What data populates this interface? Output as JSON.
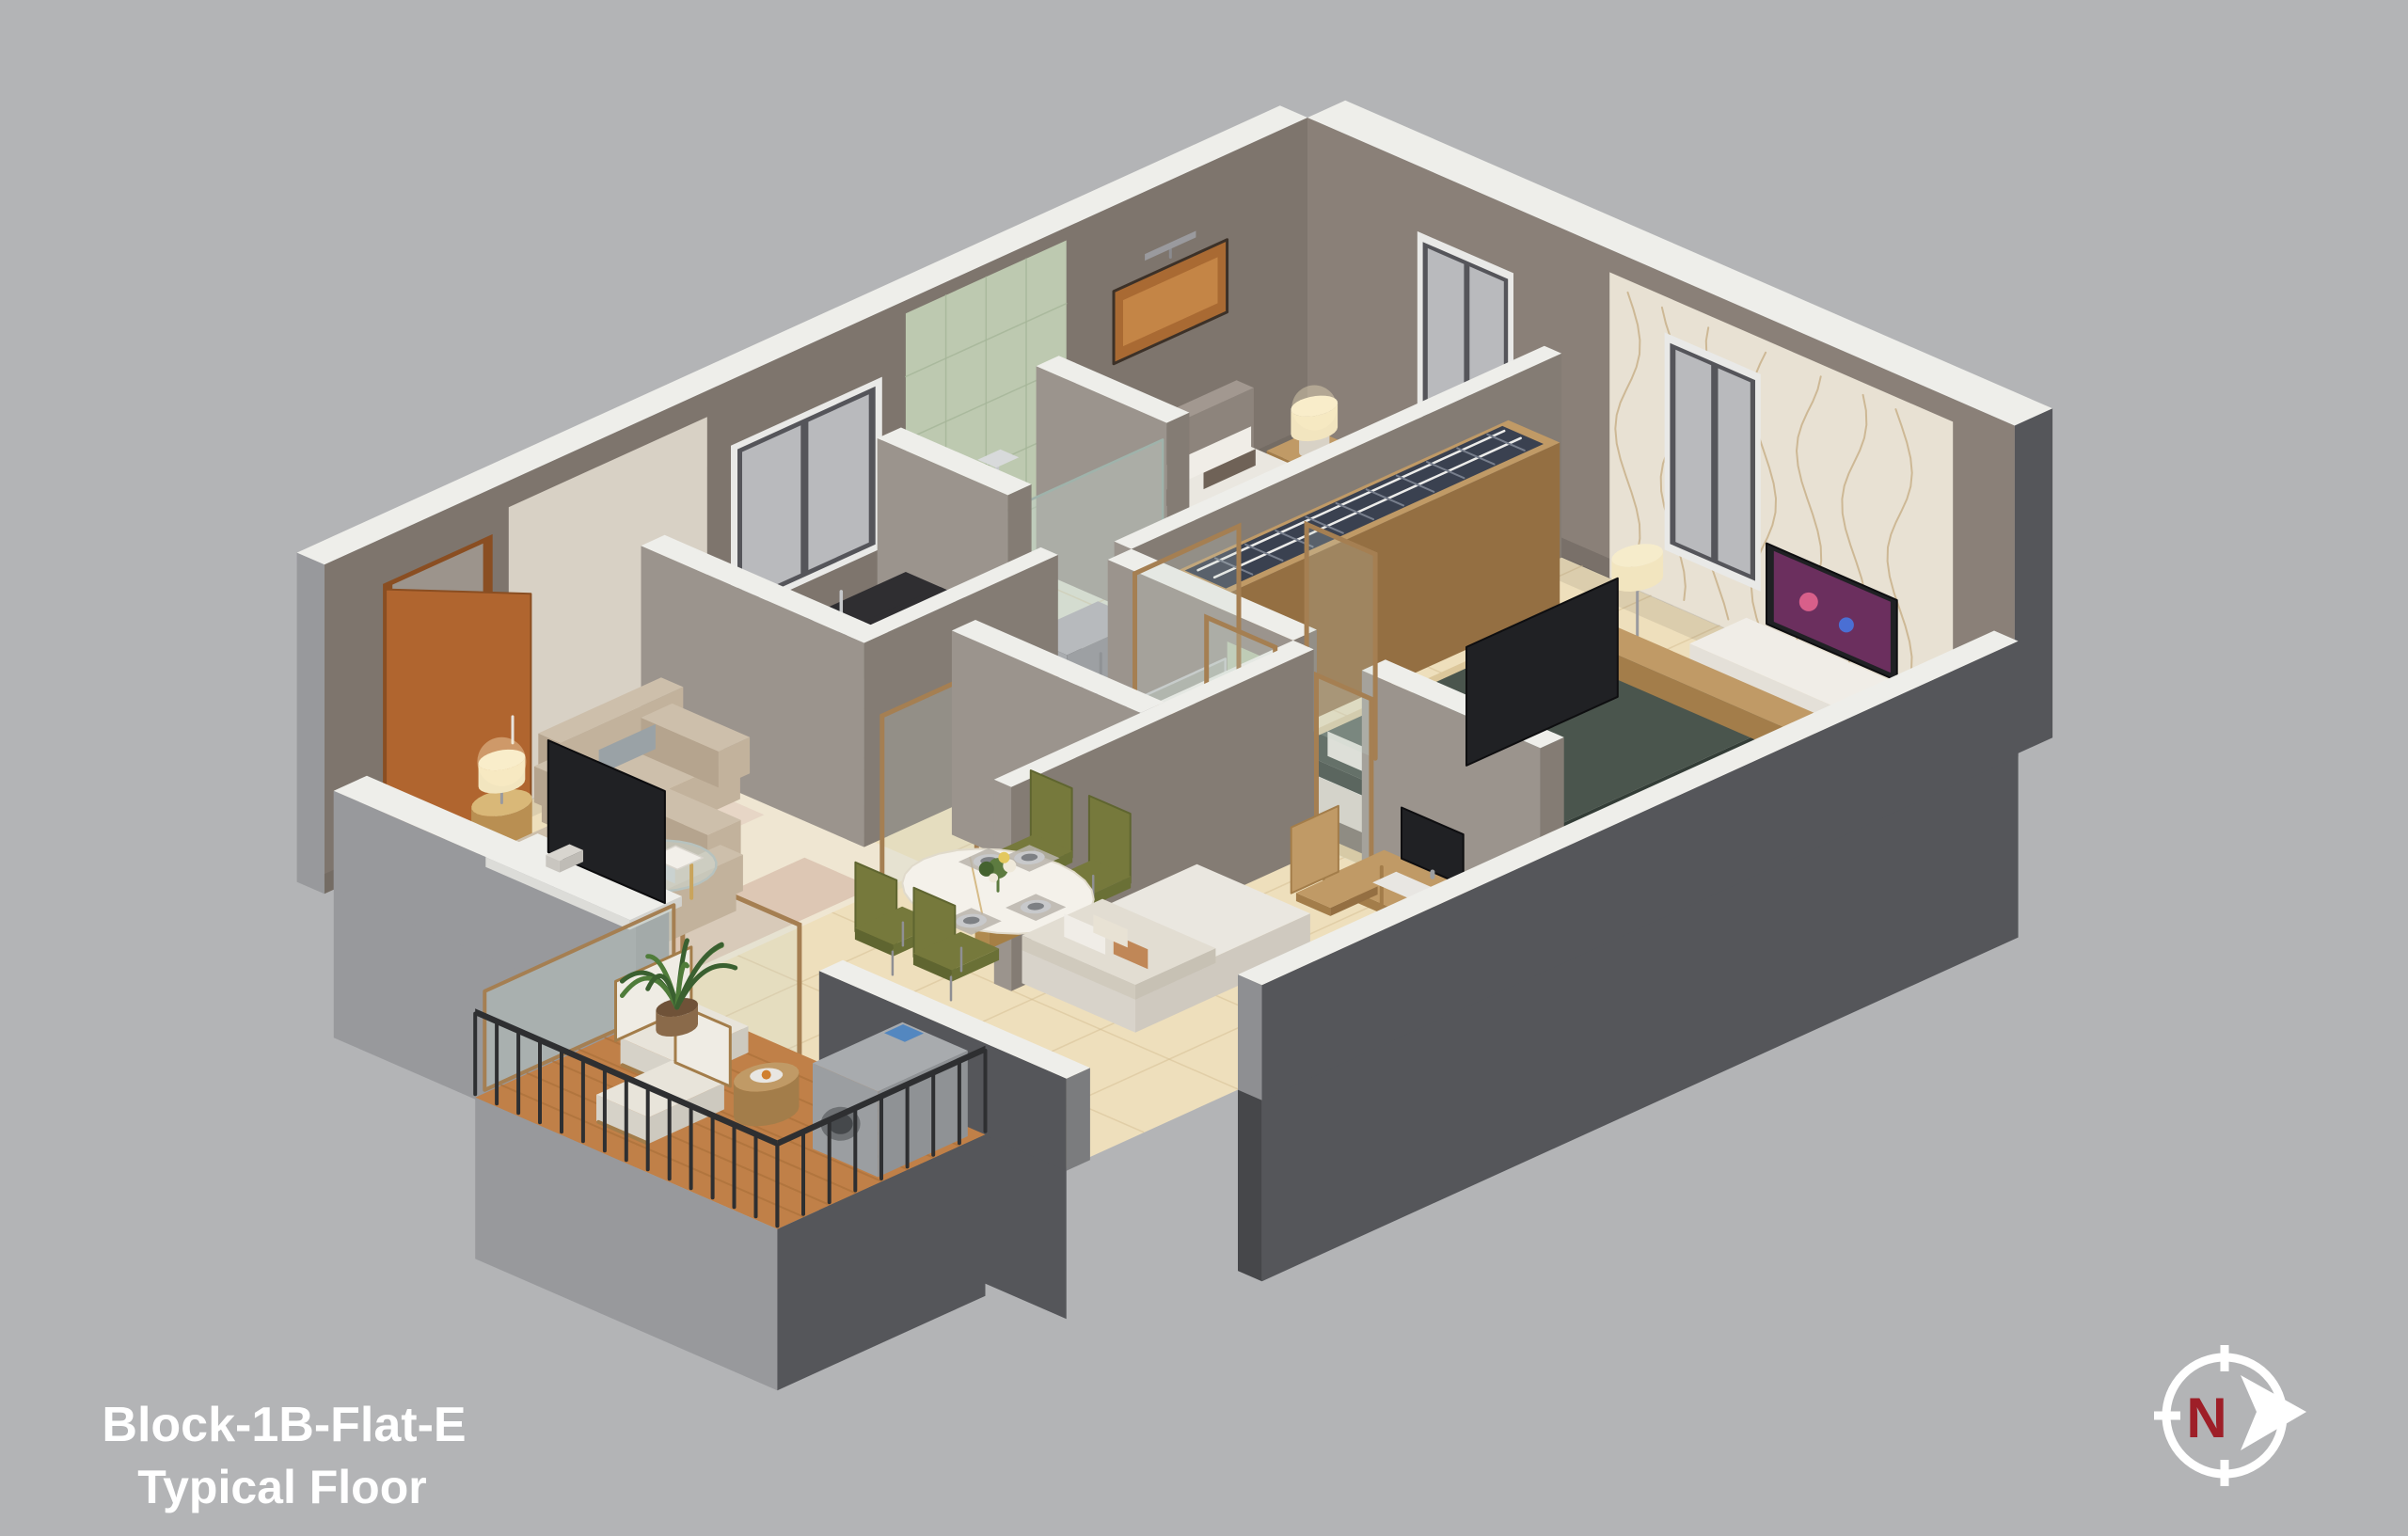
{
  "background": "#b3b4b6",
  "title": {
    "line1": "Block-1B-Flat-E",
    "line2": "Typical Floor",
    "color": "#ffffff"
  },
  "compass": {
    "label": "N",
    "label_color": "#9e1f28",
    "ring_color": "#ffffff",
    "arrow_color": "#ffffff"
  },
  "scene": {
    "type": "isometric-3d-floor-plan",
    "rooms": [
      "living-room",
      "kitchen",
      "bathroom-1",
      "bedroom-1",
      "master-bedroom",
      "ensuite-bathroom",
      "bedroom-2",
      "dining-area",
      "hallway",
      "balcony"
    ],
    "furniture": [
      "entrance-door",
      "armchair",
      "loveseat-sofa",
      "coffee-table",
      "side-table",
      "table-lamp",
      "tv-panel",
      "kitchen-counter",
      "gas-hob",
      "kitchen-sink",
      "refrigerator",
      "kitchen-window",
      "wall-painting",
      "bed",
      "nightstand",
      "wardrobe",
      "bedroom-window",
      "wallpaper-accent-wall",
      "tv-console",
      "vanity-sink",
      "toilet",
      "shower",
      "glass-door-frame",
      "dining-table",
      "dining-chair",
      "flower-centerpiece",
      "desk",
      "desk-monitor",
      "desk-chair",
      "balcony-armchair",
      "balcony-table",
      "washing-machine",
      "balcony-railing",
      "potted-plant"
    ]
  },
  "palette": {
    "bg": "#b3b4b6",
    "wallTop": "#eeeeea",
    "wallInner": "#8a8078",
    "wallInnerL": "#7e756d",
    "wallInnerDark": "#6e665f",
    "wallOuterDark": "#55565a",
    "wallOuterMid": "#98999c",
    "partition": "#9b948d",
    "partitionDark": "#847c74",
    "floor": "#eedfbc",
    "floorLine": "#d3bd92",
    "floorKitchen": "#f0eadd",
    "floorBath": "#dfe3d2",
    "tileGreen": "#bdc9b0",
    "tileGreenLine": "#a5b598",
    "marblePanel": "#d8d1c5",
    "wallpaper": "#e8e1d3",
    "wallpaperLine": "#c2a67b",
    "windowFrame": "#e9e9e7",
    "windowSash": "#55555a",
    "windowGlass": "#b9babd",
    "doorWood": "#b0652f",
    "doorWoodDark": "#8a4e22",
    "wood": "#c09a66",
    "woodDark": "#a37d4a",
    "woodSide": "#946f42",
    "clothes": "#3a4150",
    "counterTop": "#2f2e31",
    "counterSide": "#232225",
    "cabinet": "#a7a9ab",
    "steel": "#b7babd",
    "sofa": "#cdbfab",
    "sofaSW": "#b5a48e",
    "sofaSE": "#c2b29c",
    "pillowSilver": "#9aa2a6",
    "pillowBrown": "#6f6257",
    "glassTint": "rgba(195,210,205,0.4)",
    "gold": "#c9a45c",
    "tableWhite": "#f4f1ea",
    "chairOlive": "#76793c",
    "chairOliveDark": "#5f6530",
    "bedWhite": "#eae7e0",
    "bedWhiteSW": "#d8d3ca",
    "bedWhiteSE": "#cfc9bf",
    "bedRunner": "#6e4a2c",
    "headboard": "#a29890",
    "bedGreen": "#4a554d",
    "bedGreenDark": "#3d4740",
    "rugBeige": "#dcc79b",
    "rugCream": "#efe6d2",
    "rugBrown": "#8a5a3a",
    "deck": "#c08048",
    "deckDark": "#a96e39",
    "railing": "#2e2f31",
    "machine": "#a8abae",
    "plant": "#4f7c3a",
    "plantDark": "#3a6030",
    "lampShade": "#f2e5bf",
    "fixtureWhite": "#f3f2ef",
    "marbleDark": "#4a4547",
    "chrome": "#c7c9cb",
    "bronze": "#a57f52",
    "tv": "#202124",
    "tvScreen": "#6b2f5e",
    "console": "#f0ede7"
  }
}
